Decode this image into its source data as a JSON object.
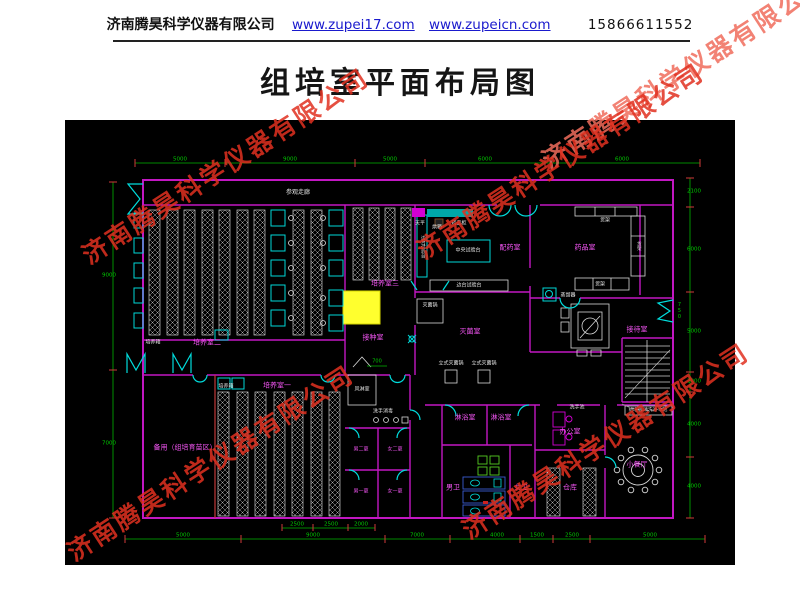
{
  "header": {
    "company": "济南腾昊科学仪器有限公司",
    "link1": "www.zupei17.com",
    "link2": "www.zupeicn.com",
    "phone": "15866611552"
  },
  "title": "组培室平面布局图",
  "watermark": "济南腾昊科学仪器有限公司",
  "colors": {
    "wall": "#c217c2",
    "door": "#00dcdc",
    "dim_green": "#00b400",
    "tick_red": "#d13a3a",
    "highlight_yellow": "#ffff2e",
    "room_label": "#f455f4"
  },
  "labels": {
    "guanlang": "参观走廊",
    "peiyang1": "培养室一",
    "peiyang2": "培养室二",
    "peiyang3": "培养室三",
    "peiyangxiang": "培养箱",
    "jiezhong": "接种室",
    "peiyao": "配药室",
    "yaopin": "药品室",
    "miejun_shi": "灭菌室",
    "jiedai": "接待室",
    "beiyong": "备用（组培育苗区）",
    "linyu": "淋浴室",
    "bangong": "办公室",
    "nanwei": "男卫",
    "nvwei": "女卫",
    "cangku": "仓库",
    "canting": "小餐厅",
    "nan2": "男二更",
    "nv2": "女二更",
    "nan1": "男一更",
    "nv1": "女一更",
    "fenglin": "风淋室",
    "xishouxiaodu": "洗手消毒",
    "xishouchi": "洗手池",
    "zhongyang": "中央试验台",
    "biantai": "边台试验台",
    "tianping": "天平",
    "hongxiang": "烘箱",
    "yaopingui": "药品柜",
    "huojia": "货架",
    "miejunguo": "灭菌锅",
    "lishi": "立式灭菌锅",
    "zhengliu": "蒸馏器",
    "xidi": "组培瓶 清洗池 水池"
  },
  "dims": {
    "top": [
      "5000",
      "9000",
      "5000",
      "6000",
      "6000"
    ],
    "bottom": [
      "5000",
      "9000",
      "7000",
      "4000",
      "1500",
      "2500",
      "5000"
    ],
    "sub": [
      "2500",
      "2500",
      "2000"
    ],
    "left": [
      "9000",
      "7000"
    ],
    "right": [
      "2100",
      "6000",
      "5000",
      "2000",
      "4000",
      "4000"
    ],
    "door": "750",
    "mid": "700"
  }
}
